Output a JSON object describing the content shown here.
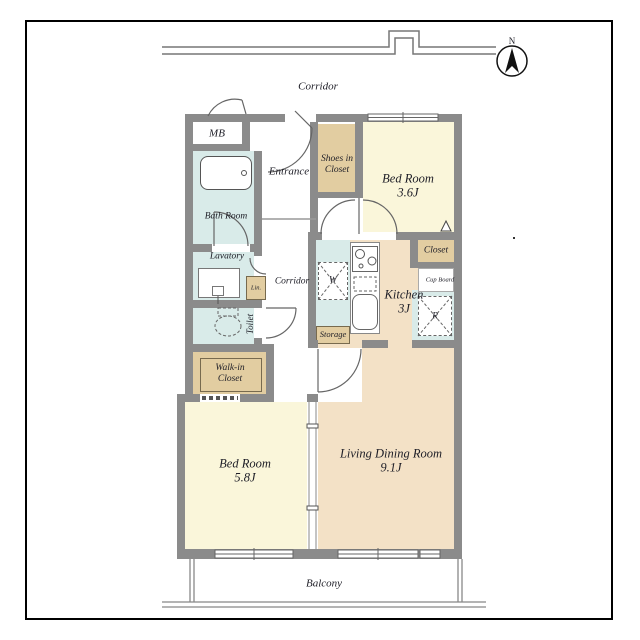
{
  "title": "Apartment floor plan",
  "compass": {
    "north_label": "N"
  },
  "labels": {
    "corridor_top": "Corridor",
    "mb": "MB",
    "entrance": "Entrance",
    "shoes_line1": "Shoes in",
    "shoes_line2": "Closet",
    "bedroom1_name": "Bed Room",
    "bedroom1_size": "3.6J",
    "closet": "Closet",
    "cupboard": "Cup Board",
    "fridge": "R",
    "washer": "W",
    "kitchen_name": "Kitchen",
    "kitchen_size": "3J",
    "storage": "Storage",
    "lavatory": "Lavatory",
    "linen": "Lin.",
    "bathroom": "Bath Room",
    "corridor_mid": "Corridor",
    "toilet": "Toilet",
    "wic_line1": "Walk-in",
    "wic_line2": "Closet",
    "bedroom2_name": "Bed Room",
    "bedroom2_size": "5.8J",
    "ldr_name": "Living Dining Room",
    "ldr_size": "9.1J",
    "balcony": "Balcony"
  },
  "rooms_summary": [
    {
      "name": "Bed Room",
      "size": "3.6J"
    },
    {
      "name": "Kitchen",
      "size": "3J"
    },
    {
      "name": "Bed Room",
      "size": "5.8J"
    },
    {
      "name": "Living Dining Room",
      "size": "9.1J"
    }
  ],
  "colors": {
    "wall": "#8b8b8b",
    "bedroom": "#faf6da",
    "living": "#f3e1c6",
    "closet": "#e2cda1",
    "wet": "#d9ebe9",
    "frame": "#000000",
    "text": "#1d1d26"
  }
}
